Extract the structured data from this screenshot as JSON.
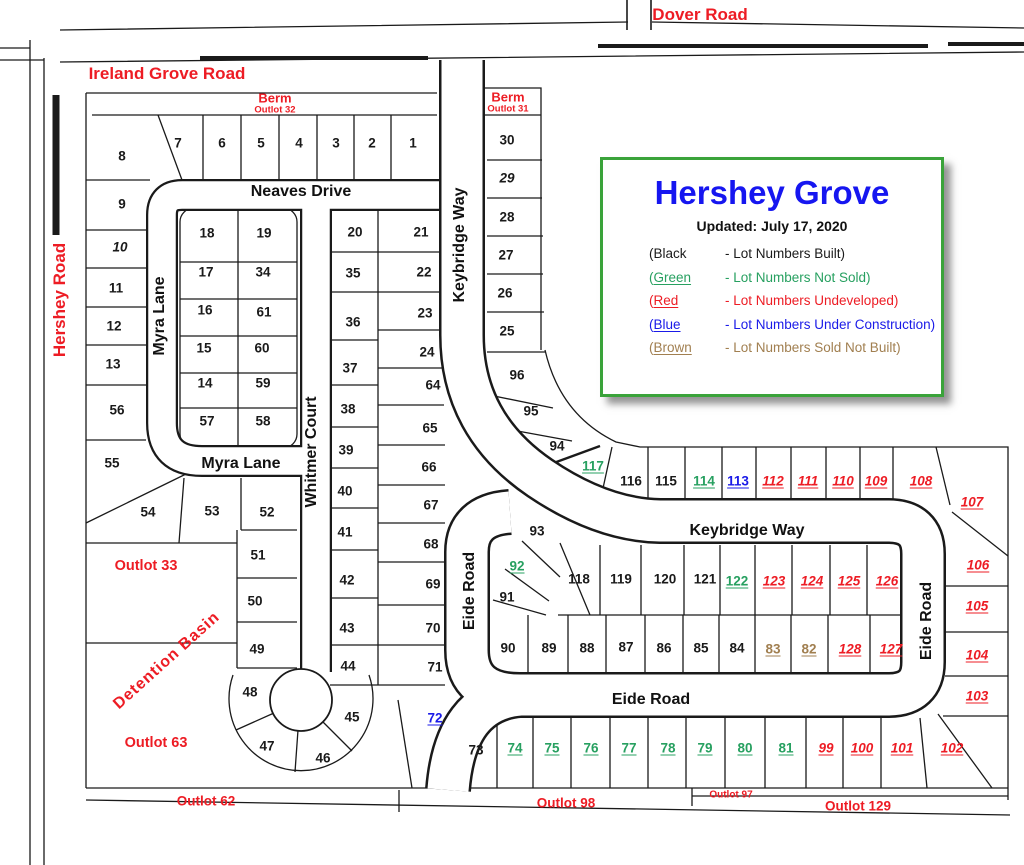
{
  "legend_box": {
    "title": "Hershey Grove",
    "updated": "Updated: July 17, 2020",
    "rows": [
      {
        "paren": "(",
        "word": "Black",
        "desc": "- Lot Numbers Built)",
        "color": "#1a1a1a",
        "underline": false
      },
      {
        "paren": "(",
        "word": "Green",
        "desc": "- Lot Numbers Not Sold)",
        "color": "#27a060",
        "underline": true
      },
      {
        "paren": "(",
        "word": "Red",
        "desc": "- Lot Numbers Undeveloped)",
        "color": "#ed1c24",
        "underline": true
      },
      {
        "paren": "(",
        "word": "Blue",
        "desc": "- Lot Numbers Under Construction)",
        "color": "#1a1ae8",
        "underline": true
      },
      {
        "paren": "(",
        "word": "Brown",
        "desc": "- Lot Numbers Sold Not Built)",
        "color": "#a17f50",
        "underline": true
      }
    ]
  },
  "status_colors": {
    "k": "#1a1a1a",
    "ki": "#1a1a1a",
    "g": "#27a060",
    "r": "#ed1c24",
    "b": "#1a1ae8",
    "w": "#a17f50"
  },
  "map": {
    "labels": [
      {
        "t": "Dover Road",
        "x": 700,
        "y": 15,
        "rot": 0,
        "cls": "road"
      },
      {
        "t": "Ireland Grove Road",
        "x": 167,
        "y": 74,
        "rot": 0,
        "cls": "road"
      },
      {
        "t": "Hershey Road",
        "x": 60,
        "y": 300,
        "rot": -90,
        "cls": "road"
      },
      {
        "t": "Berm",
        "x": 275,
        "y": 98,
        "rot": 0,
        "cls": "berm"
      },
      {
        "t": "Outlot 32",
        "x": 275,
        "y": 110,
        "rot": 0,
        "cls": "bermsub"
      },
      {
        "t": "Berm",
        "x": 508,
        "y": 97,
        "rot": 0,
        "cls": "berm"
      },
      {
        "t": "Outlot 31",
        "x": 508,
        "y": 109,
        "rot": 0,
        "cls": "bermsub"
      },
      {
        "t": "Neaves Drive",
        "x": 301,
        "y": 192,
        "rot": 0,
        "cls": "street"
      },
      {
        "t": "Myra Lane",
        "x": 160,
        "y": 316,
        "rot": -90,
        "cls": "street"
      },
      {
        "t": "Myra Lane",
        "x": 241,
        "y": 464,
        "rot": 0,
        "cls": "street"
      },
      {
        "t": "Whitmer Court",
        "x": 312,
        "y": 452,
        "rot": -90,
        "cls": "street"
      },
      {
        "t": "Keybridge Way",
        "x": 460,
        "y": 245,
        "rot": -90,
        "cls": "street"
      },
      {
        "t": "Keybridge Way",
        "x": 747,
        "y": 531,
        "rot": 0,
        "cls": "street"
      },
      {
        "t": "Eide Road",
        "x": 470,
        "y": 591,
        "rot": -90,
        "cls": "street"
      },
      {
        "t": "Eide Road",
        "x": 927,
        "y": 621,
        "rot": -90,
        "cls": "street"
      },
      {
        "t": "Eide Road",
        "x": 651,
        "y": 700,
        "rot": 0,
        "cls": "street"
      },
      {
        "t": "Outlot 33",
        "x": 146,
        "y": 566,
        "rot": 0,
        "cls": "outlot"
      },
      {
        "t": "Detention Basin",
        "x": 167,
        "y": 661,
        "rot": -42,
        "cls": "basin"
      },
      {
        "t": "Outlot 63",
        "x": 156,
        "y": 743,
        "rot": 0,
        "cls": "outlot"
      },
      {
        "t": "Outlot 62",
        "x": 206,
        "y": 801,
        "rot": 0,
        "cls": "outlot2"
      },
      {
        "t": "Outlot 98",
        "x": 566,
        "y": 803,
        "rot": 0,
        "cls": "outlot2"
      },
      {
        "t": "Outlot 97",
        "x": 731,
        "y": 795,
        "rot": 0,
        "cls": "outlot3"
      },
      {
        "t": "Outlot 129",
        "x": 858,
        "y": 806,
        "rot": 0,
        "cls": "outlot2"
      }
    ],
    "lots": [
      {
        "n": "1",
        "x": 413,
        "y": 143,
        "s": "k"
      },
      {
        "n": "2",
        "x": 372,
        "y": 143,
        "s": "k"
      },
      {
        "n": "3",
        "x": 336,
        "y": 143,
        "s": "k"
      },
      {
        "n": "4",
        "x": 299,
        "y": 143,
        "s": "k"
      },
      {
        "n": "5",
        "x": 261,
        "y": 143,
        "s": "k"
      },
      {
        "n": "6",
        "x": 222,
        "y": 143,
        "s": "k"
      },
      {
        "n": "7",
        "x": 178,
        "y": 143,
        "s": "k"
      },
      {
        "n": "8",
        "x": 122,
        "y": 156,
        "s": "k"
      },
      {
        "n": "9",
        "x": 122,
        "y": 204,
        "s": "k"
      },
      {
        "n": "10",
        "x": 120,
        "y": 247,
        "s": "ki"
      },
      {
        "n": "11",
        "x": 116,
        "y": 288,
        "s": "k"
      },
      {
        "n": "12",
        "x": 114,
        "y": 326,
        "s": "k"
      },
      {
        "n": "13",
        "x": 113,
        "y": 364,
        "s": "k"
      },
      {
        "n": "14",
        "x": 205,
        "y": 383,
        "s": "k"
      },
      {
        "n": "15",
        "x": 204,
        "y": 348,
        "s": "k"
      },
      {
        "n": "16",
        "x": 205,
        "y": 310,
        "s": "k"
      },
      {
        "n": "17",
        "x": 206,
        "y": 272,
        "s": "k"
      },
      {
        "n": "18",
        "x": 207,
        "y": 233,
        "s": "k"
      },
      {
        "n": "19",
        "x": 264,
        "y": 233,
        "s": "k"
      },
      {
        "n": "20",
        "x": 355,
        "y": 232,
        "s": "k"
      },
      {
        "n": "21",
        "x": 421,
        "y": 232,
        "s": "k"
      },
      {
        "n": "22",
        "x": 424,
        "y": 272,
        "s": "k"
      },
      {
        "n": "23",
        "x": 425,
        "y": 313,
        "s": "k"
      },
      {
        "n": "24",
        "x": 427,
        "y": 352,
        "s": "k"
      },
      {
        "n": "25",
        "x": 507,
        "y": 331,
        "s": "k"
      },
      {
        "n": "26",
        "x": 505,
        "y": 293,
        "s": "k"
      },
      {
        "n": "27",
        "x": 506,
        "y": 255,
        "s": "k"
      },
      {
        "n": "28",
        "x": 507,
        "y": 217,
        "s": "k"
      },
      {
        "n": "29",
        "x": 507,
        "y": 178,
        "s": "ki"
      },
      {
        "n": "30",
        "x": 507,
        "y": 140,
        "s": "k"
      },
      {
        "n": "34",
        "x": 263,
        "y": 272,
        "s": "k"
      },
      {
        "n": "35",
        "x": 353,
        "y": 273,
        "s": "k"
      },
      {
        "n": "36",
        "x": 353,
        "y": 322,
        "s": "k"
      },
      {
        "n": "37",
        "x": 350,
        "y": 368,
        "s": "k"
      },
      {
        "n": "38",
        "x": 348,
        "y": 409,
        "s": "k"
      },
      {
        "n": "39",
        "x": 346,
        "y": 450,
        "s": "k"
      },
      {
        "n": "40",
        "x": 345,
        "y": 491,
        "s": "k"
      },
      {
        "n": "41",
        "x": 345,
        "y": 532,
        "s": "k"
      },
      {
        "n": "42",
        "x": 347,
        "y": 580,
        "s": "k"
      },
      {
        "n": "43",
        "x": 347,
        "y": 628,
        "s": "k"
      },
      {
        "n": "44",
        "x": 348,
        "y": 666,
        "s": "k"
      },
      {
        "n": "45",
        "x": 352,
        "y": 717,
        "s": "k"
      },
      {
        "n": "46",
        "x": 323,
        "y": 758,
        "s": "k"
      },
      {
        "n": "47",
        "x": 267,
        "y": 746,
        "s": "k"
      },
      {
        "n": "48",
        "x": 250,
        "y": 692,
        "s": "k"
      },
      {
        "n": "49",
        "x": 257,
        "y": 649,
        "s": "k"
      },
      {
        "n": "50",
        "x": 255,
        "y": 601,
        "s": "k"
      },
      {
        "n": "51",
        "x": 258,
        "y": 555,
        "s": "k"
      },
      {
        "n": "52",
        "x": 267,
        "y": 512,
        "s": "k"
      },
      {
        "n": "53",
        "x": 212,
        "y": 511,
        "s": "k"
      },
      {
        "n": "54",
        "x": 148,
        "y": 512,
        "s": "k"
      },
      {
        "n": "55",
        "x": 112,
        "y": 463,
        "s": "k"
      },
      {
        "n": "56",
        "x": 117,
        "y": 410,
        "s": "k"
      },
      {
        "n": "57",
        "x": 207,
        "y": 421,
        "s": "k"
      },
      {
        "n": "58",
        "x": 263,
        "y": 421,
        "s": "k"
      },
      {
        "n": "59",
        "x": 263,
        "y": 383,
        "s": "k"
      },
      {
        "n": "60",
        "x": 262,
        "y": 348,
        "s": "k"
      },
      {
        "n": "61",
        "x": 264,
        "y": 312,
        "s": "k"
      },
      {
        "n": "64",
        "x": 433,
        "y": 385,
        "s": "k"
      },
      {
        "n": "65",
        "x": 430,
        "y": 428,
        "s": "k"
      },
      {
        "n": "66",
        "x": 429,
        "y": 467,
        "s": "k"
      },
      {
        "n": "67",
        "x": 431,
        "y": 505,
        "s": "k"
      },
      {
        "n": "68",
        "x": 431,
        "y": 544,
        "s": "k"
      },
      {
        "n": "69",
        "x": 433,
        "y": 584,
        "s": "k"
      },
      {
        "n": "70",
        "x": 433,
        "y": 628,
        "s": "k"
      },
      {
        "n": "71",
        "x": 435,
        "y": 667,
        "s": "k"
      },
      {
        "n": "72",
        "x": 435,
        "y": 718,
        "s": "b"
      },
      {
        "n": "73",
        "x": 476,
        "y": 750,
        "s": "k"
      },
      {
        "n": "74",
        "x": 515,
        "y": 748,
        "s": "g"
      },
      {
        "n": "75",
        "x": 552,
        "y": 748,
        "s": "g"
      },
      {
        "n": "76",
        "x": 591,
        "y": 748,
        "s": "g"
      },
      {
        "n": "77",
        "x": 629,
        "y": 748,
        "s": "g"
      },
      {
        "n": "78",
        "x": 668,
        "y": 748,
        "s": "g"
      },
      {
        "n": "79",
        "x": 705,
        "y": 748,
        "s": "g"
      },
      {
        "n": "80",
        "x": 745,
        "y": 748,
        "s": "g"
      },
      {
        "n": "81",
        "x": 786,
        "y": 748,
        "s": "g"
      },
      {
        "n": "82",
        "x": 809,
        "y": 649,
        "s": "w"
      },
      {
        "n": "83",
        "x": 773,
        "y": 649,
        "s": "w"
      },
      {
        "n": "84",
        "x": 737,
        "y": 648,
        "s": "k"
      },
      {
        "n": "85",
        "x": 701,
        "y": 648,
        "s": "k"
      },
      {
        "n": "86",
        "x": 664,
        "y": 648,
        "s": "k"
      },
      {
        "n": "87",
        "x": 626,
        "y": 647,
        "s": "k"
      },
      {
        "n": "88",
        "x": 587,
        "y": 648,
        "s": "k"
      },
      {
        "n": "89",
        "x": 549,
        "y": 648,
        "s": "k"
      },
      {
        "n": "90",
        "x": 508,
        "y": 648,
        "s": "k"
      },
      {
        "n": "91",
        "x": 507,
        "y": 597,
        "s": "k"
      },
      {
        "n": "92",
        "x": 517,
        "y": 566,
        "s": "g"
      },
      {
        "n": "93",
        "x": 537,
        "y": 531,
        "s": "k"
      },
      {
        "n": "94",
        "x": 557,
        "y": 446,
        "s": "k"
      },
      {
        "n": "95",
        "x": 531,
        "y": 411,
        "s": "k"
      },
      {
        "n": "96",
        "x": 517,
        "y": 375,
        "s": "k"
      },
      {
        "n": "99",
        "x": 826,
        "y": 748,
        "s": "r"
      },
      {
        "n": "100",
        "x": 862,
        "y": 748,
        "s": "r"
      },
      {
        "n": "101",
        "x": 902,
        "y": 748,
        "s": "r"
      },
      {
        "n": "102",
        "x": 952,
        "y": 748,
        "s": "r"
      },
      {
        "n": "103",
        "x": 977,
        "y": 696,
        "s": "r"
      },
      {
        "n": "104",
        "x": 977,
        "y": 655,
        "s": "r"
      },
      {
        "n": "105",
        "x": 977,
        "y": 606,
        "s": "r"
      },
      {
        "n": "106",
        "x": 978,
        "y": 565,
        "s": "r"
      },
      {
        "n": "107",
        "x": 972,
        "y": 502,
        "s": "r"
      },
      {
        "n": "108",
        "x": 921,
        "y": 481,
        "s": "r"
      },
      {
        "n": "109",
        "x": 876,
        "y": 481,
        "s": "r"
      },
      {
        "n": "110",
        "x": 843,
        "y": 481,
        "s": "r"
      },
      {
        "n": "111",
        "x": 808,
        "y": 481,
        "s": "r"
      },
      {
        "n": "112",
        "x": 773,
        "y": 481,
        "s": "r"
      },
      {
        "n": "113",
        "x": 738,
        "y": 481,
        "s": "b"
      },
      {
        "n": "114",
        "x": 704,
        "y": 481,
        "s": "g"
      },
      {
        "n": "115",
        "x": 666,
        "y": 481,
        "s": "k"
      },
      {
        "n": "116",
        "x": 631,
        "y": 481,
        "s": "k"
      },
      {
        "n": "117",
        "x": 593,
        "y": 466,
        "s": "g"
      },
      {
        "n": "118",
        "x": 579,
        "y": 579,
        "s": "k"
      },
      {
        "n": "119",
        "x": 621,
        "y": 579,
        "s": "k"
      },
      {
        "n": "120",
        "x": 665,
        "y": 579,
        "s": "k"
      },
      {
        "n": "121",
        "x": 705,
        "y": 579,
        "s": "k"
      },
      {
        "n": "122",
        "x": 737,
        "y": 581,
        "s": "g"
      },
      {
        "n": "123",
        "x": 774,
        "y": 581,
        "s": "r"
      },
      {
        "n": "124",
        "x": 812,
        "y": 581,
        "s": "r"
      },
      {
        "n": "125",
        "x": 849,
        "y": 581,
        "s": "r"
      },
      {
        "n": "126",
        "x": 887,
        "y": 581,
        "s": "r"
      },
      {
        "n": "127",
        "x": 891,
        "y": 649,
        "s": "r"
      },
      {
        "n": "128",
        "x": 850,
        "y": 649,
        "s": "r"
      }
    ]
  }
}
